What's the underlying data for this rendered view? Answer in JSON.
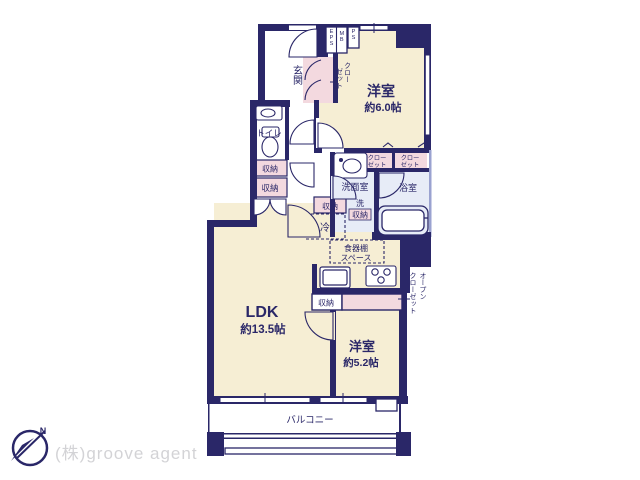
{
  "plan": {
    "rooms": {
      "western6": {
        "label": "洋室",
        "size": "約6.0帖"
      },
      "western5": {
        "label": "洋室",
        "size": "約5.2帖"
      },
      "ldk": {
        "label": "LDK",
        "size": "約13.5帖"
      },
      "entrance": {
        "label": "玄関"
      },
      "toilet": {
        "label": "トイレ"
      },
      "washroom": {
        "label": "洗面室"
      },
      "bathroom": {
        "label": "浴室"
      },
      "balcony": {
        "label": "バルコニー"
      }
    },
    "labels": {
      "storage": "収納",
      "closet_line1": "クロー",
      "closet_line2": "ゼット",
      "open_closet_col1": "オープン",
      "open_closet_col2": "クローゼット",
      "laundry": "洗",
      "fridge": "冷",
      "cupboard_line1": "食器棚",
      "cupboard_line2": "スペース",
      "eps": "EPS",
      "mb": "MB",
      "ps": "PS"
    },
    "compass": {
      "north": "N"
    },
    "watermark": "(株)groove agent",
    "colors": {
      "wall": "#2a2768",
      "room_cream": "#f6eed4",
      "closet_pink": "#f3d9df",
      "wet_blue": "#e7ecf7",
      "fixture": "#7d86c0"
    }
  }
}
